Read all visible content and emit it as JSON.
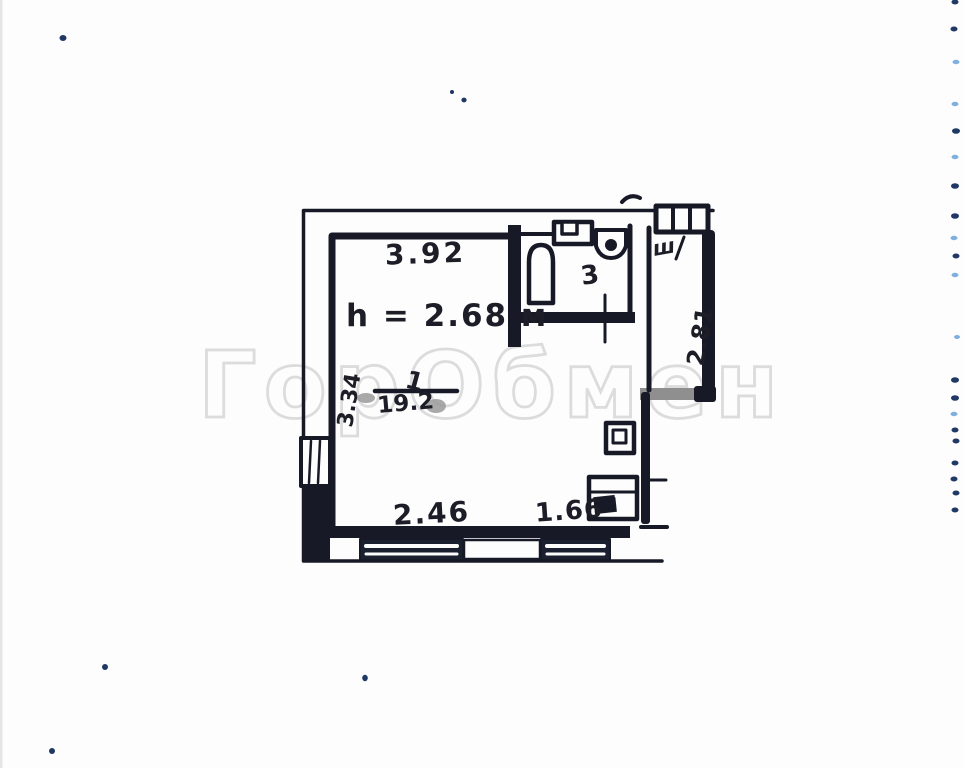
{
  "colors": {
    "ink": "#171a26",
    "watermark_outline": "#dcdcdc",
    "artifact_dot_dark": "#1f3864",
    "artifact_dot_light": "#7fb0dd"
  },
  "watermark": {
    "text": "ГорОбмен"
  },
  "floor_plan": {
    "dimensions": {
      "top_width": "3.92",
      "left_height": "3.34",
      "right_height": "2.81",
      "bottom_width_left": "2.46",
      "bottom_width_right": "1.66"
    },
    "ceiling_height_note": "h = 2.68 м",
    "main_room": {
      "number": "1",
      "area": "19.2"
    },
    "bathroom": {
      "area": "3"
    },
    "closet_mark": "ш"
  }
}
